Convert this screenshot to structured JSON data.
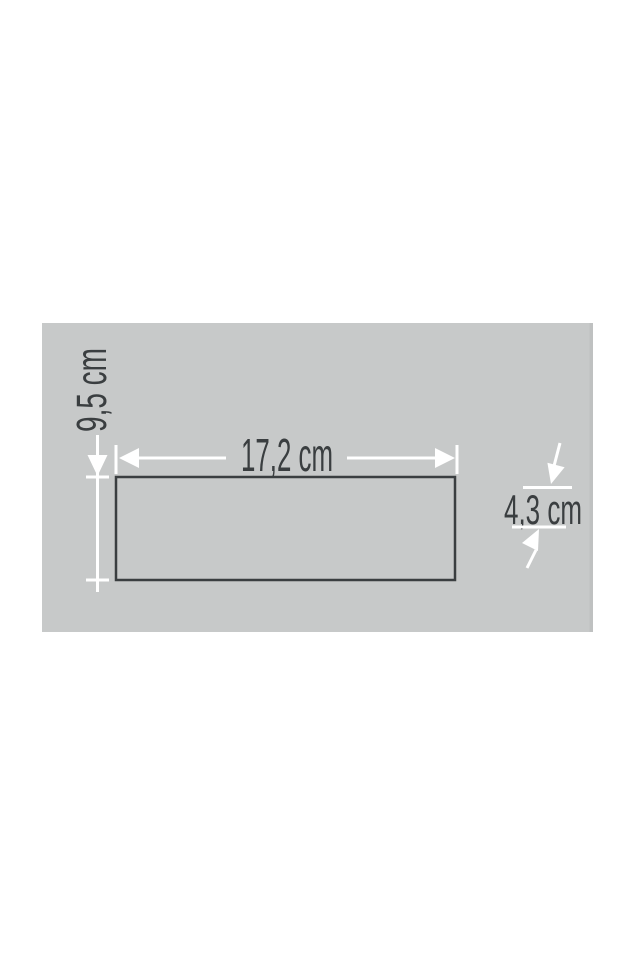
{
  "diagram": {
    "type": "dimension-drawing",
    "unit": "cm",
    "labels": {
      "height": "9,5 cm",
      "width": "17,2 cm",
      "depth": "4,3 cm"
    },
    "dimensions_cm": {
      "height": 9.5,
      "width": 17.2,
      "depth": 4.3
    },
    "colors": {
      "page_bg": "#ffffff",
      "panel_bg": "#c7c9c9",
      "panel_edge": "#bfc1c1",
      "dimension_line": "#ffffff",
      "ink": "#3a3e40"
    }
  }
}
